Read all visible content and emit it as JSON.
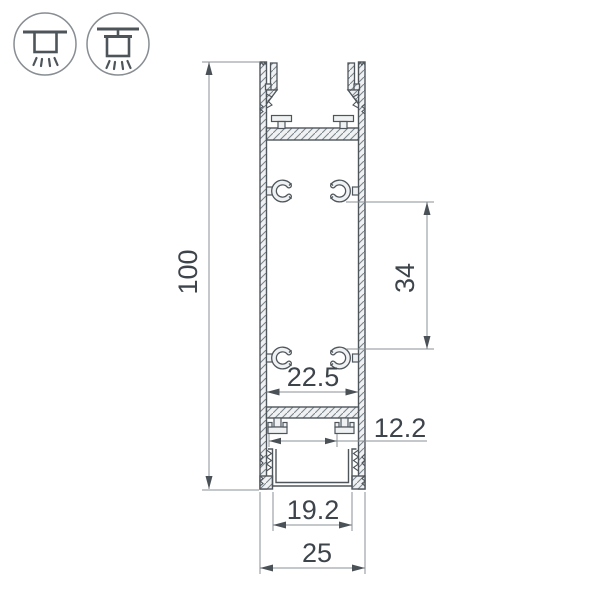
{
  "drawing": {
    "kind": "aluminum-led-profile-cross-section",
    "dimensions": {
      "overall_height": "100",
      "screw_boss_spacing": "34",
      "inner_width": "22.5",
      "rib_spacing": "12.2",
      "bottom_opening_width": "19.2",
      "overall_width": "25"
    },
    "mount_icons": [
      {
        "name": "surface-mount-icon"
      },
      {
        "name": "pendant-mount-icon"
      }
    ],
    "colors": {
      "outline": "#4e565c",
      "dimension_line": "#8a9094",
      "arrow": "#4a5157",
      "text": "#3d444b",
      "hatch_line": "#78828a",
      "material_fill": "#eff1f2",
      "icon_circle": "#878d92",
      "background": "#ffffff"
    }
  }
}
